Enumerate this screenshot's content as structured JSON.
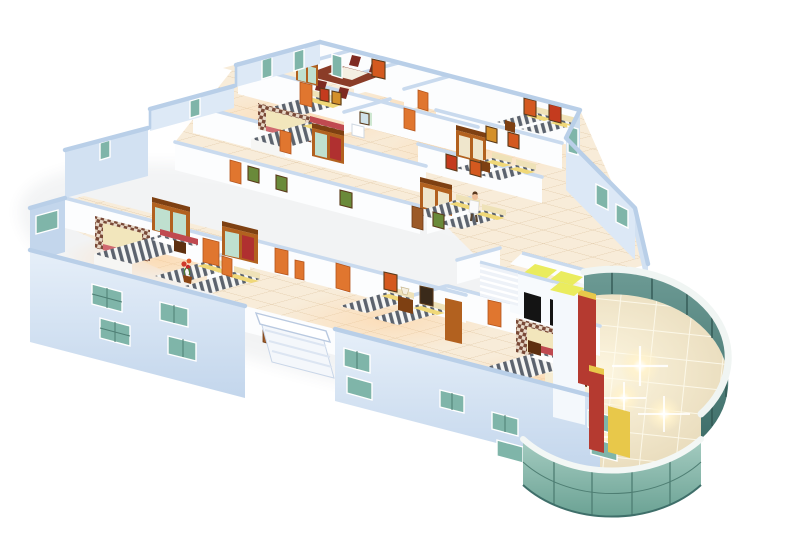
{
  "meta": {
    "title": "3D isometric cutaway floor plan rendering",
    "description": "Perspective cutaway render of a hotel floor: bedrooms with striped twin and double beds, wardrobes, orange doors, dining room, bathroom, staircase, two elevators, exterior stair notch, and a curved green glass atrium rotunda with marble floor and light flares",
    "background": "#ffffff"
  },
  "palette": {
    "floor_base": "#f8ecd9",
    "floor_line": "#e2cbaa",
    "wall_cap": "#b9cfe8",
    "wall_cap_inner": "#c9daee",
    "wall_face_white": "#fcfdfe",
    "wall_face_warm": "#fdf3e9",
    "ext_wall_light": "#dde9f6",
    "ext_wall_shade": "#c3d6ec",
    "window_glass": "#7fb5a9",
    "window_line": "#4e7e74",
    "window_frame": "#ffffff",
    "door_orange": "#e0762f",
    "door_brown": "#9c5a28",
    "wood": "#b2611f",
    "wood_dark": "#7e4012",
    "bed_white": "#f6f6f4",
    "bed_stripe": "#5c636e",
    "pillow_yellow": "#f0d878",
    "headboard_cream": "#efe2b8",
    "bed_red": "#c04a50",
    "canopy_dark": "#7a4a38",
    "canopy_light": "#e8d9c8",
    "stair_white": "#eef2f8",
    "elevator_floor": "#eaec5e",
    "elevator_door": "#141414",
    "glass_far": "#537f7a",
    "glass_far_dark": "#2f5450",
    "glass_near": "#8db9ae",
    "parapet_white": "#f0f5f3",
    "rotunda_floor": "#efe3c6",
    "rotunda_line": "#fffcf0",
    "counter_red": "#b53a30",
    "counter_yellow": "#e8c84a",
    "flare_warm": "#fff3cf",
    "art_orange": "#d4591f",
    "art_red": "#c43b1e",
    "art_green": "#6a8a3a",
    "art_frame": "#5a3a1a",
    "plant_red": "#d03a2a",
    "skin": "#f0c09a"
  },
  "scene": {
    "building": "hotel floor cutaway",
    "beds_total": 14,
    "doors_total": 14,
    "windows_total": 20,
    "rooms": [
      {
        "name": "dining-room",
        "items": [
          "dining-table",
          "chairs",
          "sideboard",
          "wall-art"
        ]
      },
      {
        "name": "wing-bedroom",
        "items": [
          "double-bed",
          "wall-art",
          "wall-art"
        ]
      },
      {
        "name": "bathroom",
        "items": [
          "sink",
          "mirror"
        ]
      },
      {
        "name": "wing-master-bedroom",
        "items": [
          "canopy-bed",
          "wardrobe"
        ]
      },
      {
        "name": "ne-twin-room-1",
        "items": [
          "bed",
          "bed",
          "wardrobe",
          "wall-art"
        ]
      },
      {
        "name": "ne-twin-room-2",
        "items": [
          "bed",
          "bed",
          "wall-art"
        ]
      },
      {
        "name": "west-master-bedroom",
        "items": [
          "canopy-bed",
          "wardrobe",
          "wardrobe",
          "nightstand"
        ]
      },
      {
        "name": "west-twin-room",
        "items": [
          "bed",
          "bed",
          "flowers"
        ]
      },
      {
        "name": "center-twin-room-upper",
        "items": [
          "bed",
          "bed",
          "wardrobe",
          "person"
        ]
      },
      {
        "name": "center-twin-room-lower",
        "items": [
          "bed",
          "bed",
          "nightstand-lamp",
          "wall-art"
        ]
      },
      {
        "name": "east-master-bedroom",
        "items": [
          "canopy-bed",
          "nightstand",
          "nightstand"
        ]
      }
    ],
    "circulation": [
      "corridor",
      "staircase",
      "elevator",
      "elevator",
      "exterior-stair-notch"
    ],
    "atrium": {
      "shape": "curved glass rotunda",
      "features": [
        "glass-curtain-wall",
        "white-parapet",
        "marble-floor-grid",
        "light-flares",
        "red-counter",
        "red-counter",
        "yellow-bench"
      ]
    }
  }
}
